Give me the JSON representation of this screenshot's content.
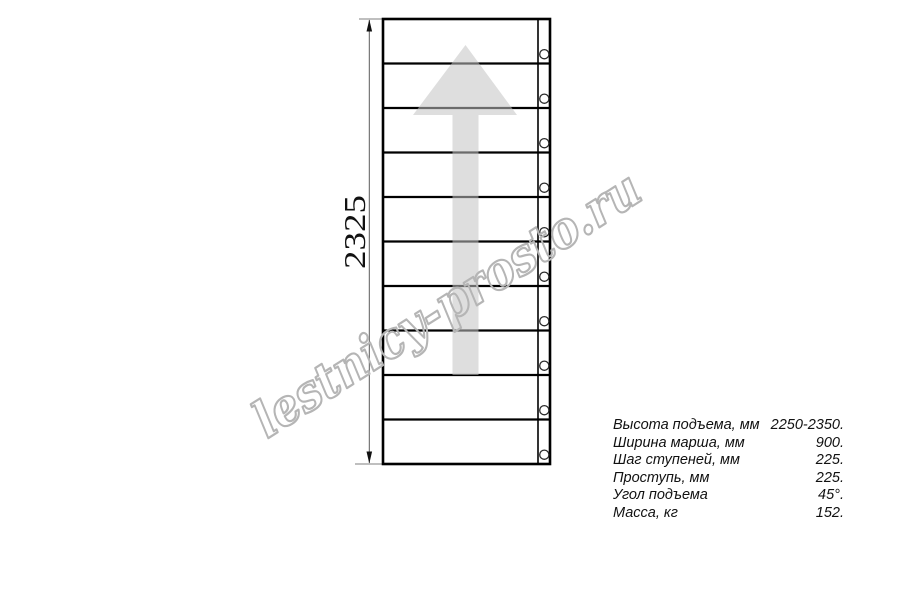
{
  "drawing": {
    "type": "staircase-plan-top-view",
    "dimension_label": "2325",
    "steps": 10,
    "arrow_direction": "up",
    "arrow_color": "#c2c2c2",
    "line_color": "#000000"
  },
  "watermark": {
    "text": "lestnicy-prosto.ru",
    "color": "#b5b5b5"
  },
  "specs": {
    "rows": [
      {
        "label": "Высота подъема, мм",
        "value": "2250-2350."
      },
      {
        "label": "Ширина марша, мм",
        "value": "900."
      },
      {
        "label": "Шаг ступеней, мм",
        "value": "225."
      },
      {
        "label": "Проступь, мм",
        "value": "225."
      },
      {
        "label": "Угол подъема",
        "value": "45°."
      },
      {
        "label": "Масса, кг",
        "value": "152."
      }
    ]
  }
}
